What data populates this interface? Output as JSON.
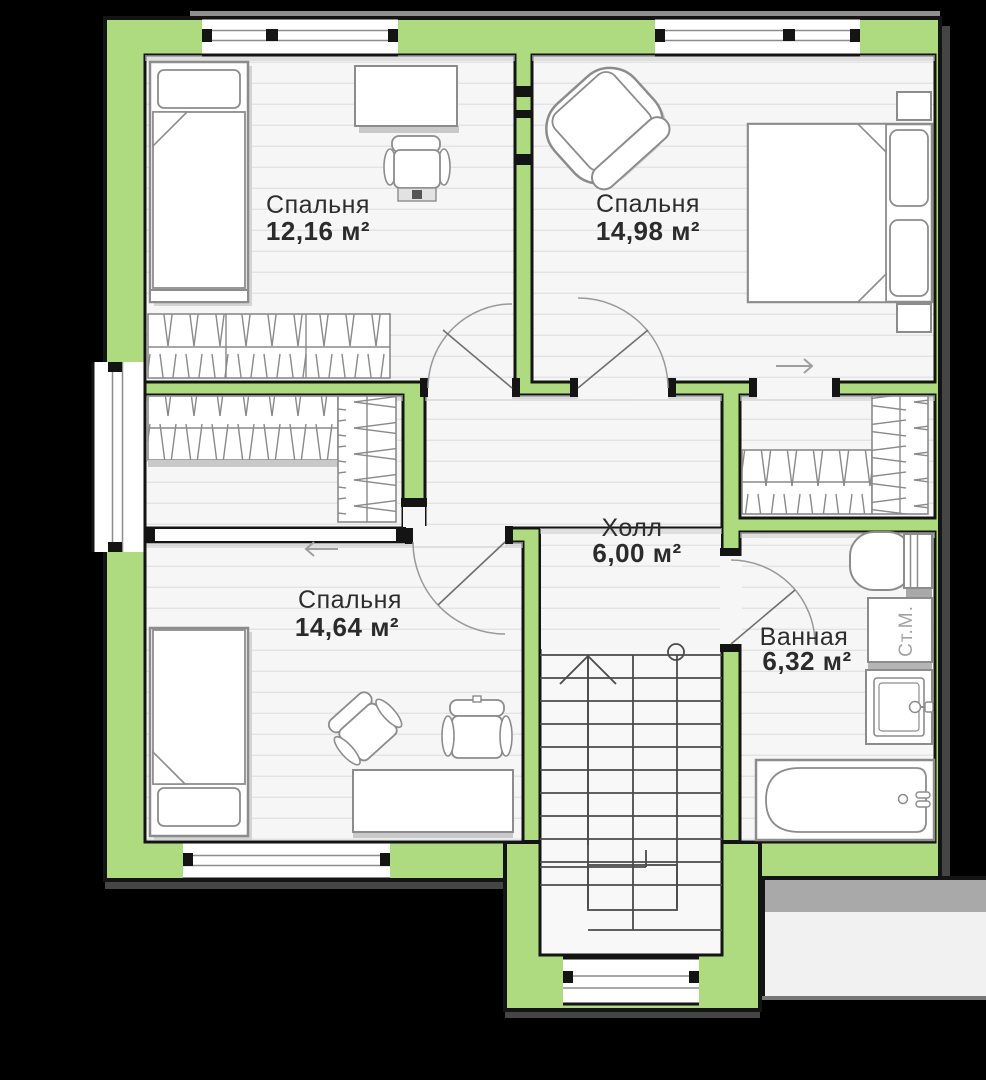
{
  "plan": {
    "background_color": "#000000",
    "wall_fill": "#aedb80",
    "outline_color": "#141414",
    "floor_color": "#f6f6f6",
    "shadow_color": "#c9c9c9",
    "rooms": [
      {
        "id": "bedroom-top-left",
        "name": "Спальня",
        "area": "12,16 м²"
      },
      {
        "id": "bedroom-top-right",
        "name": "Спальня",
        "area": "14,98 м²"
      },
      {
        "id": "bedroom-bottom-left",
        "name": "Спальня",
        "area": "14,64 м²"
      },
      {
        "id": "hall",
        "name": "Холл",
        "area": "6,00 м²"
      },
      {
        "id": "bathroom",
        "name": "Ванная",
        "area": "6,32 м²"
      }
    ],
    "labels": {
      "washing_machine": "Ст.М."
    },
    "symbols": {
      "arrow_right": "→",
      "arrow_left": "←"
    }
  }
}
